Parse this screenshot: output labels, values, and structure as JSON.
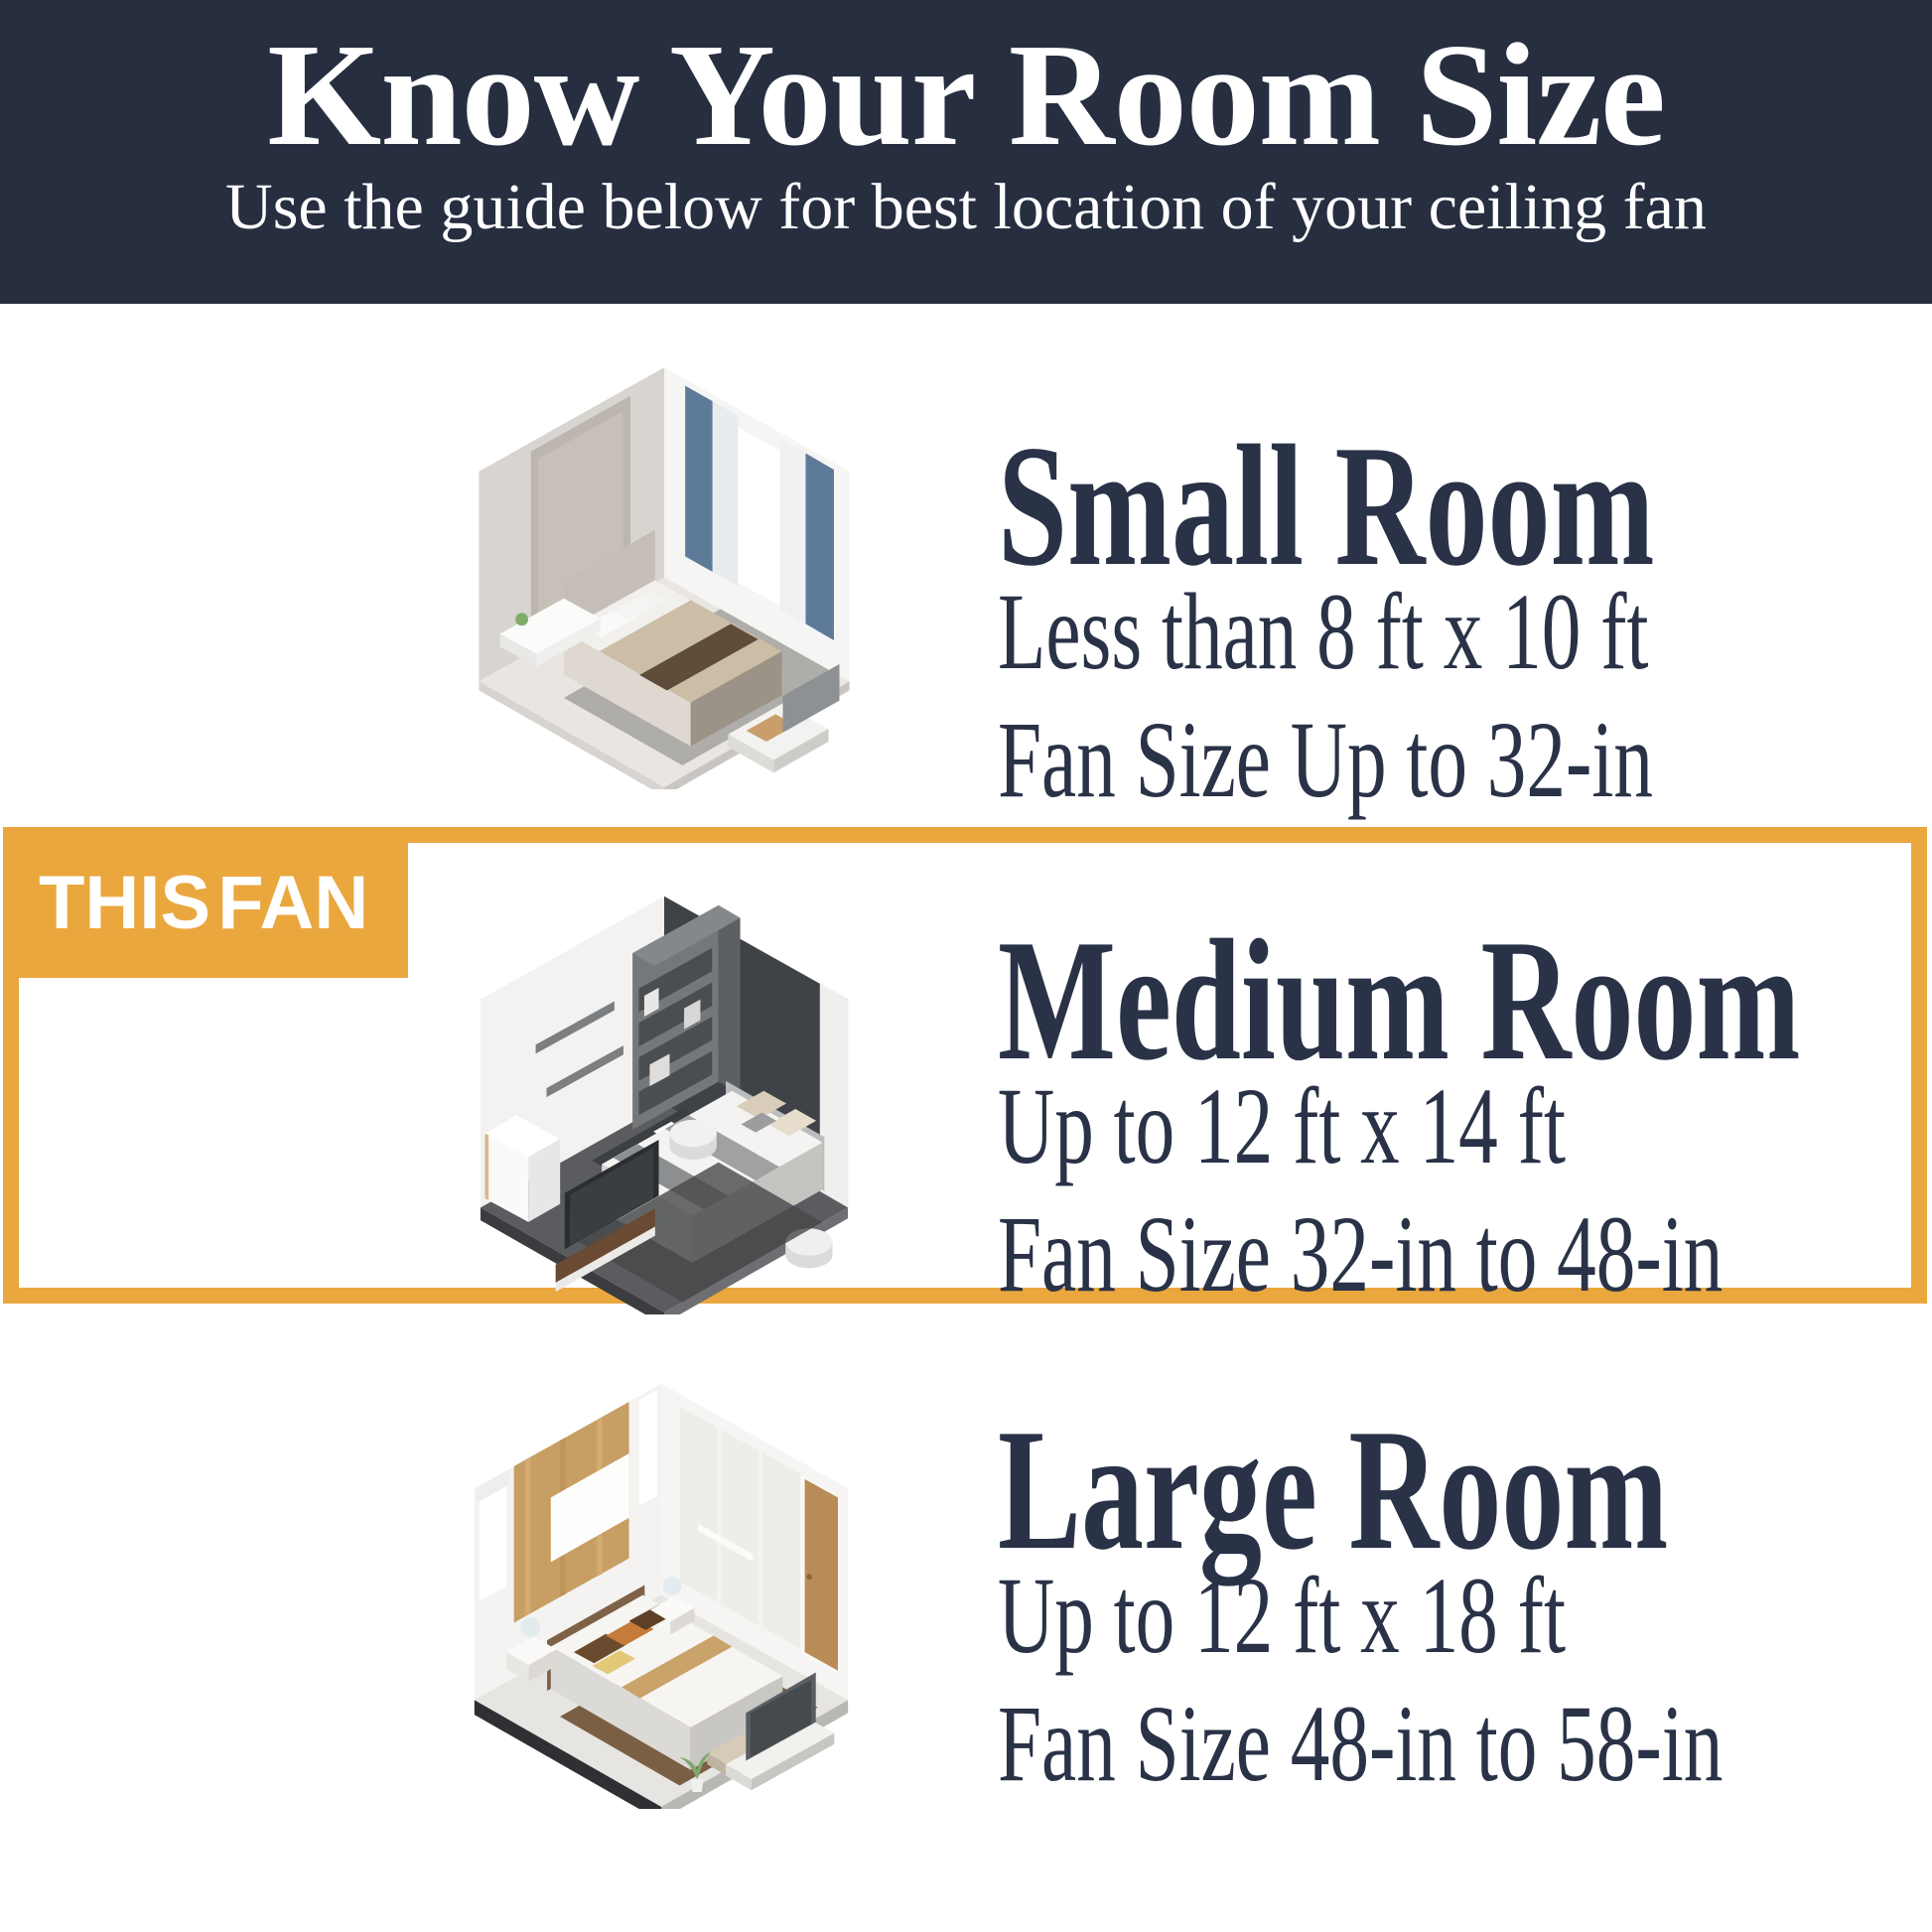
{
  "palette": {
    "header_bg": "#262E40",
    "accent_gold": "#EAA73E",
    "text_navy": "#2A3247",
    "page_bg": "#FFFFFF"
  },
  "header": {
    "title": "Know Your Room Size",
    "subtitle": "Use the guide below for best location of your ceiling fan"
  },
  "badge": {
    "label": "THIS FAN"
  },
  "sections": [
    {
      "id": "small",
      "title": "Small Room",
      "dimensions": "Less than 8 ft x 10 ft",
      "fan_size": "Fan Size Up to 32-in",
      "highlighted": false,
      "image": "small-room-isometric-bedroom"
    },
    {
      "id": "medium",
      "title": "Medium Room",
      "dimensions": "Up to 12 ft x 14 ft",
      "fan_size": "Fan Size 32-in to 48-in",
      "highlighted": true,
      "image": "medium-room-isometric-bedroom"
    },
    {
      "id": "large",
      "title": "Large Room",
      "dimensions": "Up to 12 ft x 18 ft",
      "fan_size": "Fan Size 48-in to 58-in",
      "highlighted": false,
      "image": "large-room-isometric-bedroom"
    }
  ]
}
